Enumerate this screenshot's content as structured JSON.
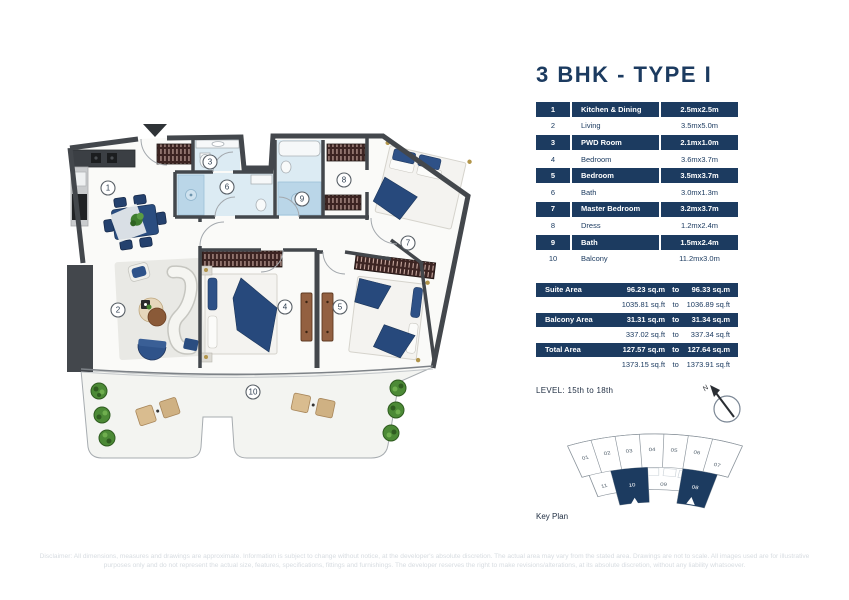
{
  "title": "3 BHK - TYPE I",
  "rooms_table": {
    "rows": [
      {
        "no": "1",
        "name": "Kitchen & Dining",
        "dim": "2.5mx2.5m"
      },
      {
        "no": "2",
        "name": "Living",
        "dim": "3.5mx5.0m"
      },
      {
        "no": "3",
        "name": "PWD Room",
        "dim": "2.1mx1.0m"
      },
      {
        "no": "4",
        "name": "Bedroom",
        "dim": "3.6mx3.7m"
      },
      {
        "no": "5",
        "name": "Bedroom",
        "dim": "3.5mx3.7m"
      },
      {
        "no": "6",
        "name": "Bath",
        "dim": "3.0mx1.3m"
      },
      {
        "no": "7",
        "name": "Master Bedroom",
        "dim": "3.2mx3.7m"
      },
      {
        "no": "8",
        "name": "Dress",
        "dim": "1.2mx2.4m"
      },
      {
        "no": "9",
        "name": "Bath",
        "dim": "1.5mx2.4m"
      },
      {
        "no": "10",
        "name": "Balcony",
        "dim": "11.2mx3.0m"
      }
    ]
  },
  "area_table": {
    "to_word": "to",
    "rows": [
      {
        "label": "Suite Area",
        "sqm_from": "96.23 sq.m",
        "sqm_to": "96.33 sq.m",
        "sqft_from": "1035.81 sq.ft",
        "sqft_to": "1036.89 sq.ft"
      },
      {
        "label": "Balcony Area",
        "sqm_from": "31.31 sq.m",
        "sqm_to": "31.34 sq.m",
        "sqft_from": "337.02 sq.ft",
        "sqft_to": "337.34 sq.ft"
      },
      {
        "label": "Total Area",
        "sqm_from": "127.57 sq.m",
        "sqm_to": "127.64 sq.m",
        "sqft_from": "1373.15 sq.ft",
        "sqft_to": "1373.91 sq.ft"
      }
    ]
  },
  "level_text": "LEVEL: 15th to 18th",
  "compass": {
    "north": "N"
  },
  "key_plan": {
    "label": "Key Plan",
    "units": [
      {
        "no": "01",
        "x": 22,
        "y": 42,
        "r": -18,
        "hl": false
      },
      {
        "no": "02",
        "x": 45,
        "y": 36,
        "r": -13,
        "hl": false
      },
      {
        "no": "03",
        "x": 68,
        "y": 33,
        "r": -8,
        "hl": false
      },
      {
        "no": "04",
        "x": 92,
        "y": 31,
        "r": -2,
        "hl": false
      },
      {
        "no": "05",
        "x": 115,
        "y": 32,
        "r": 4,
        "hl": false
      },
      {
        "no": "06",
        "x": 139,
        "y": 35,
        "r": 10,
        "hl": false
      },
      {
        "no": "07",
        "x": 160,
        "y": 52,
        "r": 16,
        "hl": false
      },
      {
        "no": "11",
        "x": 42,
        "y": 80,
        "r": -15,
        "hl": false
      },
      {
        "no": "10",
        "x": 71,
        "y": 79,
        "r": -7,
        "hl": true
      },
      {
        "no": "09",
        "x": 104,
        "y": 78,
        "r": 2,
        "hl": false
      },
      {
        "no": "08",
        "x": 137,
        "y": 82,
        "r": 12,
        "hl": true
      }
    ]
  },
  "floor_plan": {
    "room_labels": [
      {
        "no": "1",
        "x": 53,
        "y": 68
      },
      {
        "no": "2",
        "x": 63,
        "y": 190
      },
      {
        "no": "3",
        "x": 155,
        "y": 42
      },
      {
        "no": "4",
        "x": 230,
        "y": 187
      },
      {
        "no": "5",
        "x": 285,
        "y": 187
      },
      {
        "no": "6",
        "x": 172,
        "y": 67
      },
      {
        "no": "7",
        "x": 353,
        "y": 123
      },
      {
        "no": "8",
        "x": 289,
        "y": 60
      },
      {
        "no": "9",
        "x": 247,
        "y": 79
      },
      {
        "no": "10",
        "x": 198,
        "y": 272
      }
    ]
  },
  "disclaimer": "Disclaimer: All dimensions, measures and drawings are approximate. Information is subject to change without notice, at the developer's absolute discretion. The actual area may vary from the stated area. Drawings are not to scale. All images used are for illustrative purposes only and do not represent the actual size, features, specifications, fittings and furnishings. The developer reserves the right to make revisions/alterations, at its absolute discretion, without any liability whatsoever.",
  "colors": {
    "navy": "#1c3b60",
    "wall": "#43474c",
    "bath_tile": "#dcebf3",
    "furniture_blue": "#2a4d80",
    "plant_green": "#4c8a36",
    "keyplan_highlight": "#1c3b60"
  }
}
